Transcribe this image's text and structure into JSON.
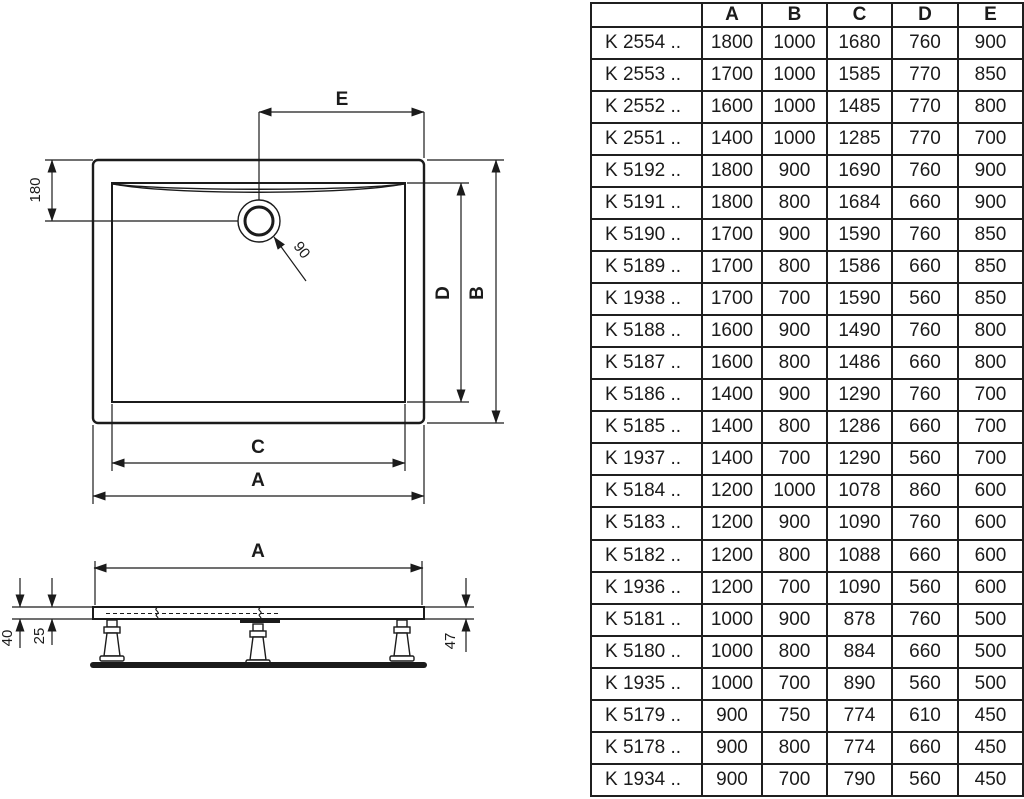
{
  "drawing": {
    "top_view": {
      "drain_offset_top_dim": "E",
      "drain_offset_side_dim": "180",
      "drain_diameter_dim": "90",
      "inner_length_dim": "D",
      "outer_length_dim": "B",
      "inner_width_dim": "C",
      "outer_width_dim": "A"
    },
    "side_view": {
      "width_dim": "A",
      "edge_height_dim": "40",
      "inner_height_dim": "25",
      "total_height_dim": "47"
    }
  },
  "table": {
    "columns": [
      "",
      "A",
      "B",
      "C",
      "D",
      "E"
    ],
    "rows": [
      {
        "model": "K 2554 ..",
        "values": [
          "1800",
          "1000",
          "1680",
          "760",
          "900"
        ]
      },
      {
        "model": "K 2553 ..",
        "values": [
          "1700",
          "1000",
          "1585",
          "770",
          "850"
        ]
      },
      {
        "model": "K 2552 ..",
        "values": [
          "1600",
          "1000",
          "1485",
          "770",
          "800"
        ]
      },
      {
        "model": "K 2551 ..",
        "values": [
          "1400",
          "1000",
          "1285",
          "770",
          "700"
        ]
      },
      {
        "model": "K 5192 ..",
        "values": [
          "1800",
          "900",
          "1690",
          "760",
          "900"
        ]
      },
      {
        "model": "K 5191 ..",
        "values": [
          "1800",
          "800",
          "1684",
          "660",
          "900"
        ]
      },
      {
        "model": "K 5190 ..",
        "values": [
          "1700",
          "900",
          "1590",
          "760",
          "850"
        ]
      },
      {
        "model": "K 5189 ..",
        "values": [
          "1700",
          "800",
          "1586",
          "660",
          "850"
        ]
      },
      {
        "model": "K 1938 ..",
        "values": [
          "1700",
          "700",
          "1590",
          "560",
          "850"
        ]
      },
      {
        "model": "K 5188 ..",
        "values": [
          "1600",
          "900",
          "1490",
          "760",
          "800"
        ]
      },
      {
        "model": "K 5187 ..",
        "values": [
          "1600",
          "800",
          "1486",
          "660",
          "800"
        ]
      },
      {
        "model": "K 5186 ..",
        "values": [
          "1400",
          "900",
          "1290",
          "760",
          "700"
        ]
      },
      {
        "model": "K 5185 ..",
        "values": [
          "1400",
          "800",
          "1286",
          "660",
          "700"
        ]
      },
      {
        "model": "K 1937 ..",
        "values": [
          "1400",
          "700",
          "1290",
          "560",
          "700"
        ]
      },
      {
        "model": "K 5184 ..",
        "values": [
          "1200",
          "1000",
          "1078",
          "860",
          "600"
        ]
      },
      {
        "model": "K 5183 ..",
        "values": [
          "1200",
          "900",
          "1090",
          "760",
          "600"
        ]
      },
      {
        "model": "K 5182 ..",
        "values": [
          "1200",
          "800",
          "1088",
          "660",
          "600"
        ]
      },
      {
        "model": "K 1936 ..",
        "values": [
          "1200",
          "700",
          "1090",
          "560",
          "600"
        ]
      },
      {
        "model": "K 5181 ..",
        "values": [
          "1000",
          "900",
          "878",
          "760",
          "500"
        ]
      },
      {
        "model": "K 5180 ..",
        "values": [
          "1000",
          "800",
          "884",
          "660",
          "500"
        ]
      },
      {
        "model": "K 1935 ..",
        "values": [
          "1000",
          "700",
          "890",
          "560",
          "500"
        ]
      },
      {
        "model": "K 5179 ..",
        "values": [
          "900",
          "750",
          "774",
          "610",
          "450"
        ]
      },
      {
        "model": "K 5178 ..",
        "values": [
          "900",
          "800",
          "774",
          "660",
          "450"
        ]
      },
      {
        "model": "K 1934 ..",
        "values": [
          "900",
          "700",
          "790",
          "560",
          "450"
        ]
      }
    ]
  }
}
